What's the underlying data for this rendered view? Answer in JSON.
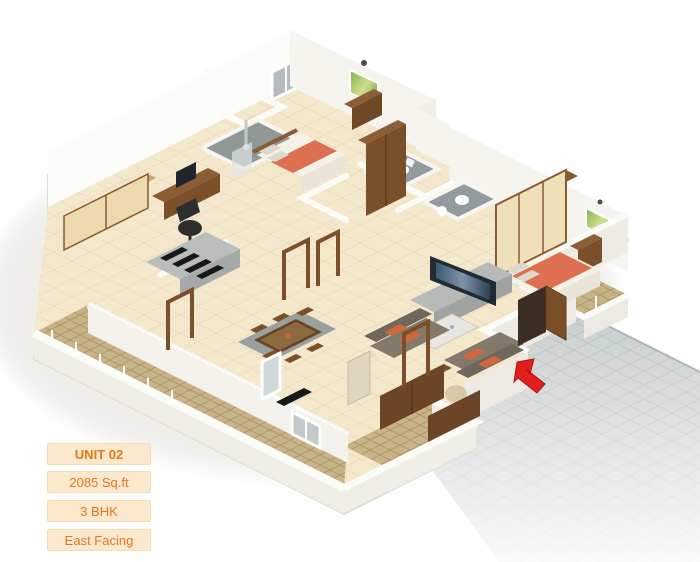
{
  "info_panel": {
    "unit": "UNIT 02",
    "area": "2085 Sq.ft",
    "bhk": "3 BHK",
    "facing": "East Facing"
  },
  "floorplan": {
    "kind": "3d-isometric-apartment-render",
    "rooms": [
      "bedroom-1-study",
      "bedroom-2",
      "master-bedroom",
      "living-room",
      "dining-area",
      "kitchen",
      "bathroom-1",
      "bathroom-2",
      "bathroom-3",
      "balcony-southwest",
      "balcony-southeast",
      "balcony-master",
      "entry-corridor"
    ],
    "entrance_marker": "red-arrow-pointing-to-main-door"
  },
  "colors": {
    "label_bg": "#fbe8cd",
    "label_text": "#e0761f",
    "arrow_red": "#e31e1e",
    "floor_cream": "#f4e8cc",
    "wall_white": "#fcfcf9",
    "balcony_tile_tan": "#c9b488",
    "corridor_gray": "#c6cdcb",
    "wood_brown": "#7a4f2a",
    "bed_orange": "#dd7050"
  }
}
